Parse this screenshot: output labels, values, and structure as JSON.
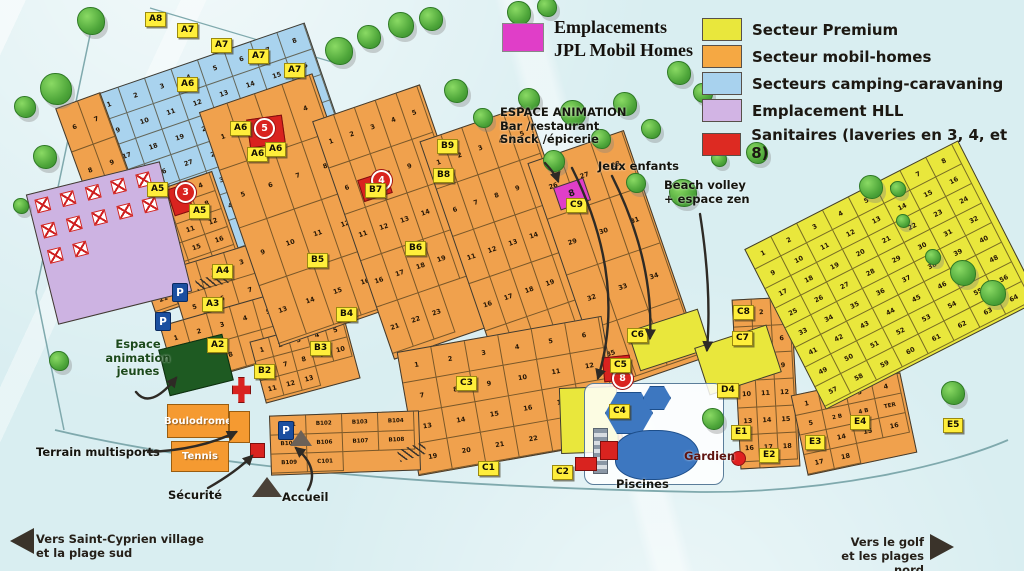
{
  "title": {
    "line1": "Emplacements",
    "line2": "JPL Mobil Homes",
    "swatch_color": "#e03ec8"
  },
  "legend": {
    "items": [
      {
        "label": "Secteur Premium",
        "color": "#e9e73c"
      },
      {
        "label": "Secteur mobil-homes",
        "color": "#f5a843"
      },
      {
        "label": "Secteurs camping-caravaning",
        "color": "#a8d2ee"
      },
      {
        "label": "Emplacement HLL",
        "color": "#d2b4e4"
      },
      {
        "label": "Sanitaires (laveries en 3, 4, et 8)",
        "color": "#dd2a22"
      }
    ]
  },
  "signs": {
    "sw": {
      "line1": "Vers Saint-Cyprien village",
      "line2": "et la plage sud"
    },
    "ne": {
      "line1": "Vers le golf",
      "line2": "et les plages nord"
    }
  },
  "map": {
    "colors": {
      "blue": "#a9d3ee",
      "orange": "#f0a14d",
      "yellow": "#e9e73c",
      "purple": "#cdb3e2",
      "red": "#d9231f",
      "magenta": "#e03ec8",
      "pool": "#3d77c0",
      "green_area": "#1e5a22"
    },
    "zones": [
      {
        "name": "camping-caravaning-A",
        "type": "blue",
        "x": 116,
        "y": 54,
        "w": 226,
        "h": 192,
        "rot": -19,
        "cw": 28,
        "ch": 27,
        "from": 1,
        "to": 51
      },
      {
        "name": "mobil-left-col",
        "type": "orange",
        "x": 78,
        "y": 96,
        "w": 48,
        "h": 142,
        "rot": -20,
        "cw": 23,
        "ch": 46,
        "from": 6,
        "to": 11
      },
      {
        "name": "mobil-A5",
        "type": "orange",
        "x": 134,
        "y": 184,
        "w": 100,
        "h": 118,
        "rot": -19,
        "cw": 24,
        "ch": 19,
        "from": 1,
        "to": 24
      },
      {
        "name": "mobil-A3-A4",
        "type": "orange",
        "x": 178,
        "y": 250,
        "w": 118,
        "h": 90,
        "rot": -17,
        "cw": 29,
        "ch": 29,
        "from": 1,
        "to": 12
      },
      {
        "name": "mobil-A2",
        "type": "orange",
        "x": 166,
        "y": 308,
        "w": 122,
        "h": 64,
        "rot": -16,
        "cw": 24,
        "ch": 31,
        "from": 1,
        "to": 10
      },
      {
        "name": "mobil-B2",
        "type": "orange",
        "x": 256,
        "y": 328,
        "w": 98,
        "h": 64,
        "rot": -15,
        "cw": 19,
        "ch": 20,
        "from": 1,
        "to": 13
      },
      {
        "name": "mobil-B5-B7",
        "type": "orange",
        "x": 236,
        "y": 86,
        "w": 120,
        "h": 248,
        "rot": -19,
        "cw": 29,
        "ch": 61,
        "from": 1,
        "to": 16
      },
      {
        "name": "mobil-B8-B9",
        "type": "orange",
        "x": 350,
        "y": 96,
        "w": 114,
        "h": 252,
        "rot": -19,
        "cw": 22,
        "ch": 49,
        "from": 1,
        "to": 23
      },
      {
        "name": "mobil-C9-west",
        "type": "orange",
        "x": 458,
        "y": 116,
        "w": 114,
        "h": 256,
        "rot": -19,
        "cw": 22,
        "ch": 50,
        "from": 1,
        "to": 25
      },
      {
        "name": "mobil-C9-east",
        "type": "orange",
        "x": 564,
        "y": 140,
        "w": 102,
        "h": 242,
        "rot": -19,
        "cw": 33,
        "ch": 59,
        "from": 26,
        "to": 37
      },
      {
        "name": "mobil-C1-C3",
        "type": "orange",
        "x": 406,
        "y": 333,
        "w": 208,
        "h": 126,
        "rot": -10,
        "cw": 34,
        "ch": 31,
        "from": 1,
        "to": 23
      },
      {
        "name": "mobil-B1",
        "type": "orange",
        "x": 270,
        "y": 413,
        "w": 150,
        "h": 60,
        "rot": -2,
        "cw": 36,
        "ch": 19,
        "labels": [
          "B101",
          "B102",
          "B103",
          "B104",
          "B105",
          "B106",
          "B107",
          "B108",
          "B109",
          "C101"
        ]
      },
      {
        "name": "mobil-E-col",
        "type": "orange",
        "x": 736,
        "y": 298,
        "w": 60,
        "h": 170,
        "rot": -3,
        "cw": 19,
        "ch": 27,
        "from": 1,
        "to": 19
      },
      {
        "name": "mobil-E-south",
        "type": "orange",
        "x": 798,
        "y": 383,
        "w": 112,
        "h": 82,
        "rot": -12,
        "cw": 27,
        "ch": 20,
        "labels": [
          "1",
          "2",
          "3",
          "4",
          "5",
          "2 B",
          "4 B",
          "TER",
          "4 TER",
          "14",
          "15",
          "16",
          "17",
          "18"
        ]
      },
      {
        "name": "premium-main",
        "type": "yellow",
        "x": 772,
        "y": 185,
        "w": 240,
        "h": 180,
        "rot": -27,
        "cw": 29,
        "ch": 22,
        "from": 1,
        "to": 64
      },
      {
        "name": "premium-jeux-enfants",
        "type": "yellow",
        "x": 632,
        "y": 319,
        "w": 74,
        "h": 42,
        "rot": -18
      },
      {
        "name": "premium-beach-volley",
        "type": "yellow",
        "x": 700,
        "y": 335,
        "w": 76,
        "h": 50,
        "rot": -18
      },
      {
        "name": "premium-espace-animation",
        "type": "yellow",
        "x": 560,
        "y": 387,
        "w": 58,
        "h": 66,
        "rot": -2
      },
      {
        "name": "emplacement-HLL",
        "type": "purple",
        "x": 40,
        "y": 176,
        "w": 138,
        "h": 134,
        "rot": -14,
        "hll_count": 12
      }
    ],
    "badges": [
      {
        "label": "A8",
        "x": 145,
        "y": 12
      },
      {
        "label": "A7",
        "x": 177,
        "y": 23
      },
      {
        "label": "A7",
        "x": 211,
        "y": 38
      },
      {
        "label": "A7",
        "x": 248,
        "y": 49
      },
      {
        "label": "A7",
        "x": 284,
        "y": 63
      },
      {
        "label": "A6",
        "x": 177,
        "y": 77
      },
      {
        "label": "A6",
        "x": 230,
        "y": 121
      },
      {
        "label": "A6",
        "x": 247,
        "y": 147
      },
      {
        "label": "A6",
        "x": 265,
        "y": 142
      },
      {
        "label": "A5",
        "x": 147,
        "y": 182
      },
      {
        "label": "A5",
        "x": 189,
        "y": 204
      },
      {
        "label": "A4",
        "x": 212,
        "y": 264
      },
      {
        "label": "A3",
        "x": 202,
        "y": 297
      },
      {
        "label": "A2",
        "x": 207,
        "y": 338
      },
      {
        "label": "B2",
        "x": 254,
        "y": 364
      },
      {
        "label": "B3",
        "x": 310,
        "y": 341
      },
      {
        "label": "B4",
        "x": 336,
        "y": 307
      },
      {
        "label": "B5",
        "x": 307,
        "y": 253
      },
      {
        "label": "B6",
        "x": 405,
        "y": 241
      },
      {
        "label": "B7",
        "x": 365,
        "y": 183
      },
      {
        "label": "B8",
        "x": 433,
        "y": 168
      },
      {
        "label": "B9",
        "x": 437,
        "y": 139
      },
      {
        "label": "C1",
        "x": 478,
        "y": 461
      },
      {
        "label": "C2",
        "x": 552,
        "y": 465
      },
      {
        "label": "C3",
        "x": 456,
        "y": 376
      },
      {
        "label": "C4",
        "x": 609,
        "y": 404
      },
      {
        "label": "C5",
        "x": 610,
        "y": 358
      },
      {
        "label": "C6",
        "x": 627,
        "y": 328
      },
      {
        "label": "C7",
        "x": 732,
        "y": 331
      },
      {
        "label": "C8",
        "x": 733,
        "y": 305
      },
      {
        "label": "C9",
        "x": 566,
        "y": 198
      },
      {
        "label": "D4",
        "x": 717,
        "y": 383
      },
      {
        "label": "E1",
        "x": 731,
        "y": 425
      },
      {
        "label": "E2",
        "x": 759,
        "y": 448
      },
      {
        "label": "E3",
        "x": 805,
        "y": 435
      },
      {
        "label": "E4",
        "x": 850,
        "y": 415
      },
      {
        "label": "E5",
        "x": 943,
        "y": 418
      }
    ],
    "sanitaires": [
      {
        "n": "3",
        "bx": 170,
        "by": 186,
        "bw": 18,
        "bh": 26,
        "brot": -18,
        "cx": 184,
        "cy": 191
      },
      {
        "n": "4",
        "bx": 360,
        "by": 175,
        "bw": 28,
        "bh": 21,
        "brot": -18,
        "cx": 380,
        "cy": 179
      },
      {
        "n": "5",
        "bx": 248,
        "by": 117,
        "bw": 34,
        "bh": 27,
        "brot": -8,
        "cx": 263,
        "cy": 127
      },
      {
        "n": "8",
        "bx": 603,
        "by": 356,
        "bw": 26,
        "bh": 23,
        "brot": -6,
        "cx": 621,
        "cy": 377
      }
    ],
    "jpl_plot": {
      "label": "8",
      "x": 556,
      "y": 182,
      "w": 30,
      "h": 22,
      "rot": -19
    },
    "annotations": [
      {
        "id": "espace-animation-label",
        "lines": [
          "ESPACE ANIMATION",
          "Bar /restaurant",
          "Snack /épicerie"
        ],
        "x": 500,
        "y": 106,
        "size": 11.5,
        "color": "#15150f"
      },
      {
        "id": "jeux-enfants-label",
        "lines": [
          "Jeux enfants"
        ],
        "x": 598,
        "y": 160,
        "size": 11.5,
        "color": "#15150f"
      },
      {
        "id": "beach-volley-label",
        "lines": [
          "Beach volley",
          "+ espace zen"
        ],
        "x": 664,
        "y": 179,
        "size": 11.5,
        "color": "#15150f"
      },
      {
        "id": "espace-animation-jeunes-label",
        "lines": [
          "Espace",
          "animation",
          "jeunes"
        ],
        "x": 100,
        "y": 338,
        "size": 11.5,
        "color": "#1c4a1c",
        "align": "center",
        "width": 76
      },
      {
        "id": "terrain-multisports-label",
        "lines": [
          "Terrain multisports"
        ],
        "x": 36,
        "y": 446,
        "size": 11.5,
        "color": "#15150f"
      },
      {
        "id": "securite-label",
        "lines": [
          "Sécurité"
        ],
        "x": 168,
        "y": 489,
        "size": 11.5,
        "color": "#15150f"
      },
      {
        "id": "accueil-label",
        "lines": [
          "Accueil"
        ],
        "x": 282,
        "y": 491,
        "size": 11.5,
        "color": "#15150f"
      },
      {
        "id": "piscines-label",
        "lines": [
          "Piscines"
        ],
        "x": 616,
        "y": 478,
        "size": 11.5,
        "color": "#15150f"
      },
      {
        "id": "gardien-label",
        "lines": [
          "Gardien"
        ],
        "x": 684,
        "y": 450,
        "size": 11.5,
        "color": "#5f1410"
      }
    ],
    "facilities": [
      {
        "id": "espace-animation-jeunes-area",
        "x": 163,
        "y": 341,
        "w": 66,
        "h": 48,
        "rot": -14,
        "fill": "#1e5a22",
        "border": "#0e2f10",
        "label": ""
      },
      {
        "id": "boulodrome-area",
        "x": 167,
        "y": 404,
        "w": 62,
        "h": 34,
        "rot": 0,
        "fill": "#f59a31",
        "border": "#9a5d10",
        "label": "Boulodrome"
      },
      {
        "id": "tennis-area",
        "x": 171,
        "y": 441,
        "w": 58,
        "h": 31,
        "rot": 0,
        "fill": "#f59a31",
        "border": "#9a5d10",
        "label": "Tennis"
      },
      {
        "id": "multisports-court",
        "x": 229,
        "y": 411,
        "w": 21,
        "h": 32,
        "rot": 0,
        "fill": "#f59a31",
        "border": "#9a5d10",
        "label": ""
      }
    ],
    "red_shapes": [
      {
        "id": "sanitaire-building-icon",
        "x": 232,
        "y": 377,
        "w": 17,
        "h": 24,
        "cross": true
      },
      {
        "id": "securite-post-icon",
        "x": 250,
        "y": 443,
        "w": 13,
        "h": 13
      },
      {
        "id": "pool-building-icon",
        "x": 600,
        "y": 441,
        "w": 16,
        "h": 17
      },
      {
        "id": "pool-entry-icon",
        "x": 575,
        "y": 457,
        "w": 20,
        "h": 12
      }
    ],
    "gardien_dot": {
      "x": 731,
      "y": 451,
      "d": 13,
      "color": "#e02020"
    },
    "parking": [
      {
        "x": 172,
        "y": 283
      },
      {
        "x": 155,
        "y": 312
      },
      {
        "x": 278,
        "y": 421
      }
    ],
    "triangles": [
      {
        "id": "accueil-marker",
        "x": 252,
        "y": 477,
        "w": 30,
        "h": 20,
        "color": "#4a4138"
      },
      {
        "id": "reception-marker",
        "x": 290,
        "y": 430,
        "w": 22,
        "h": 16,
        "color": "#6b6158"
      }
    ],
    "pools": {
      "x": 584,
      "y": 383,
      "w": 138,
      "h": 100
    },
    "trees": [
      [
        90,
        20,
        26
      ],
      [
        55,
        88,
        30
      ],
      [
        24,
        106,
        20
      ],
      [
        44,
        156,
        22
      ],
      [
        20,
        205,
        14
      ],
      [
        338,
        50,
        26
      ],
      [
        368,
        36,
        22
      ],
      [
        400,
        24,
        24
      ],
      [
        430,
        18,
        22
      ],
      [
        455,
        90,
        22
      ],
      [
        482,
        117,
        18
      ],
      [
        518,
        12,
        22
      ],
      [
        546,
        6,
        18
      ],
      [
        528,
        98,
        20
      ],
      [
        553,
        160,
        20
      ],
      [
        572,
        112,
        24
      ],
      [
        600,
        138,
        18
      ],
      [
        624,
        103,
        22
      ],
      [
        650,
        128,
        18
      ],
      [
        678,
        72,
        22
      ],
      [
        702,
        92,
        18
      ],
      [
        635,
        182,
        18
      ],
      [
        682,
        192,
        26
      ],
      [
        718,
        158,
        14
      ],
      [
        756,
        152,
        20
      ],
      [
        870,
        186,
        22
      ],
      [
        897,
        188,
        14
      ],
      [
        902,
        220,
        12
      ],
      [
        932,
        256,
        14
      ],
      [
        962,
        272,
        24
      ],
      [
        992,
        292,
        24
      ],
      [
        952,
        392,
        22
      ],
      [
        712,
        418,
        20
      ],
      [
        58,
        360,
        18
      ]
    ],
    "hatches": [
      {
        "x": 196,
        "y": 276,
        "w": 32,
        "h": 11,
        "rot": -15
      },
      {
        "x": 398,
        "y": 446,
        "w": 28,
        "h": 12,
        "rot": -18
      }
    ]
  }
}
